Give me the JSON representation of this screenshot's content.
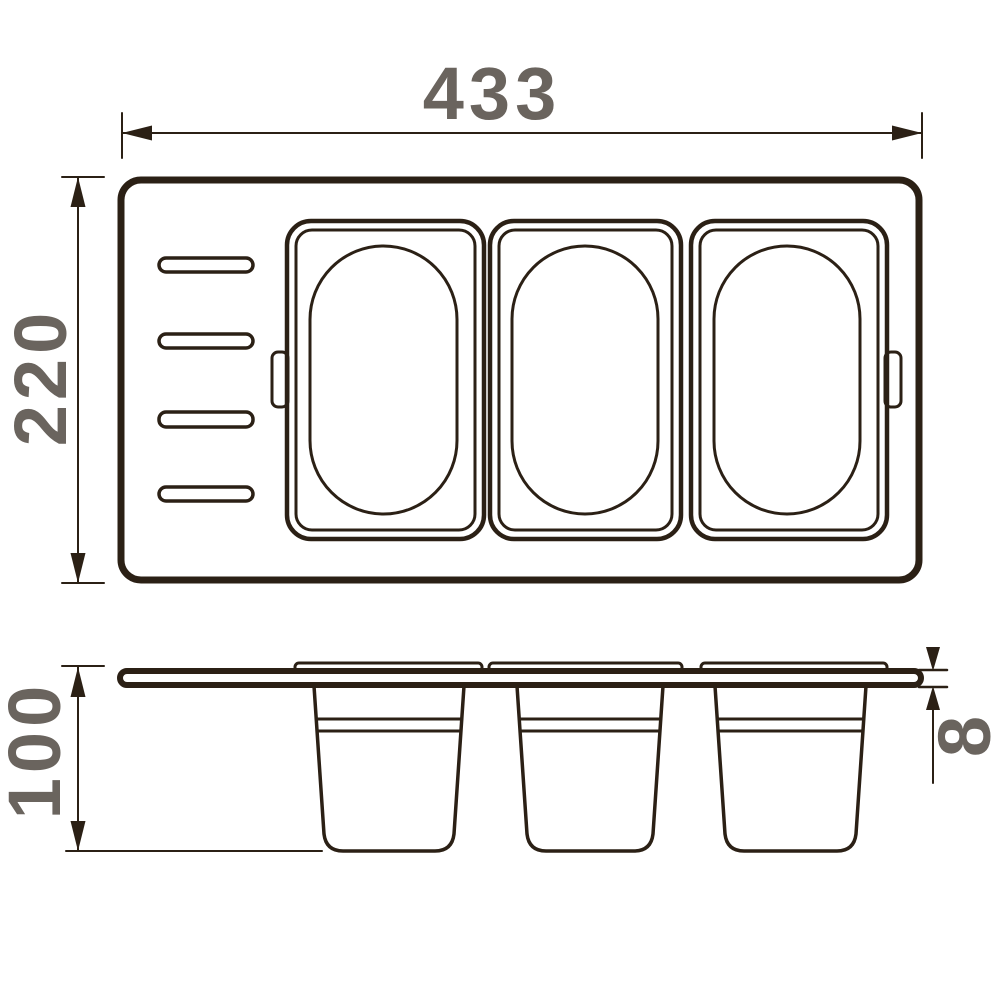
{
  "drawing": {
    "title": "Tray with containers - dimensioned technical drawing",
    "colors": {
      "line": "#2b2015",
      "dim_text": "#6a645e",
      "background": "#ffffff"
    },
    "dimensions": {
      "width": "433",
      "height": "220",
      "depth": "100",
      "thickness": "8"
    },
    "top_view": {
      "container_count": 3,
      "slot_count": 4,
      "tab_count": 2
    },
    "side_view": {
      "container_count": 3
    }
  }
}
